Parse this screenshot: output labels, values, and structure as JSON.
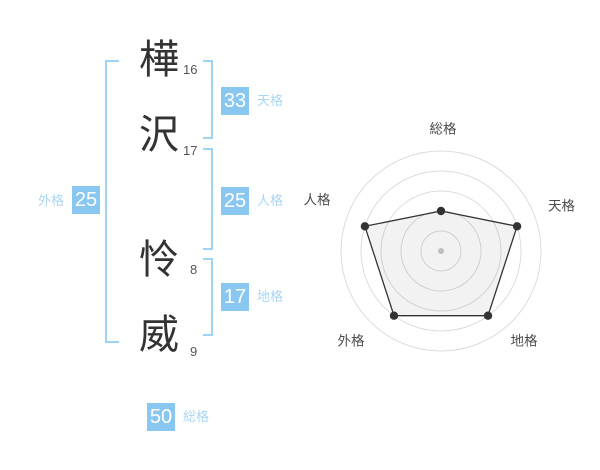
{
  "page": {
    "title": "姓名判断結果",
    "background": "#ffffff"
  },
  "name": {
    "surname": [
      {
        "char": "樺",
        "strokes": "16"
      },
      {
        "char": "沢",
        "strokes": "17"
      }
    ],
    "given": [
      {
        "char": "怜",
        "strokes": "8"
      },
      {
        "char": "威",
        "strokes": "9"
      }
    ]
  },
  "categories": {
    "tenkaku": {
      "label": "天格",
      "value": "33"
    },
    "jinkaku": {
      "label": "人格",
      "value": "25"
    },
    "chikaku": {
      "label": "地格",
      "value": "17"
    },
    "gaikaku": {
      "label": "外格",
      "value": "25"
    },
    "soukaku": {
      "label": "総格",
      "value": "50"
    }
  },
  "colors": {
    "accent_blue": "#8AC7F0",
    "light_blue_text": "#A9D6F5",
    "bracket_blue": "#9DD3F4",
    "kanji_ink": "#333333",
    "chart_grid": "#DCDCDC",
    "chart_line": "#333333",
    "chart_center_dot": "#C9C9C9"
  },
  "chart_data": {
    "type": "radar",
    "axes": [
      "総格",
      "天格",
      "地格",
      "外格",
      "人格"
    ],
    "series": [
      {
        "values": [
          2,
          4,
          4,
          4,
          4
        ]
      }
    ],
    "max": 5,
    "rings": 5,
    "grid": "concentric-circles",
    "legend_position": "none",
    "axis_numbers": {
      "総格": 50,
      "天格": 33,
      "地格": 17,
      "外格": 25,
      "人格": 25
    }
  }
}
